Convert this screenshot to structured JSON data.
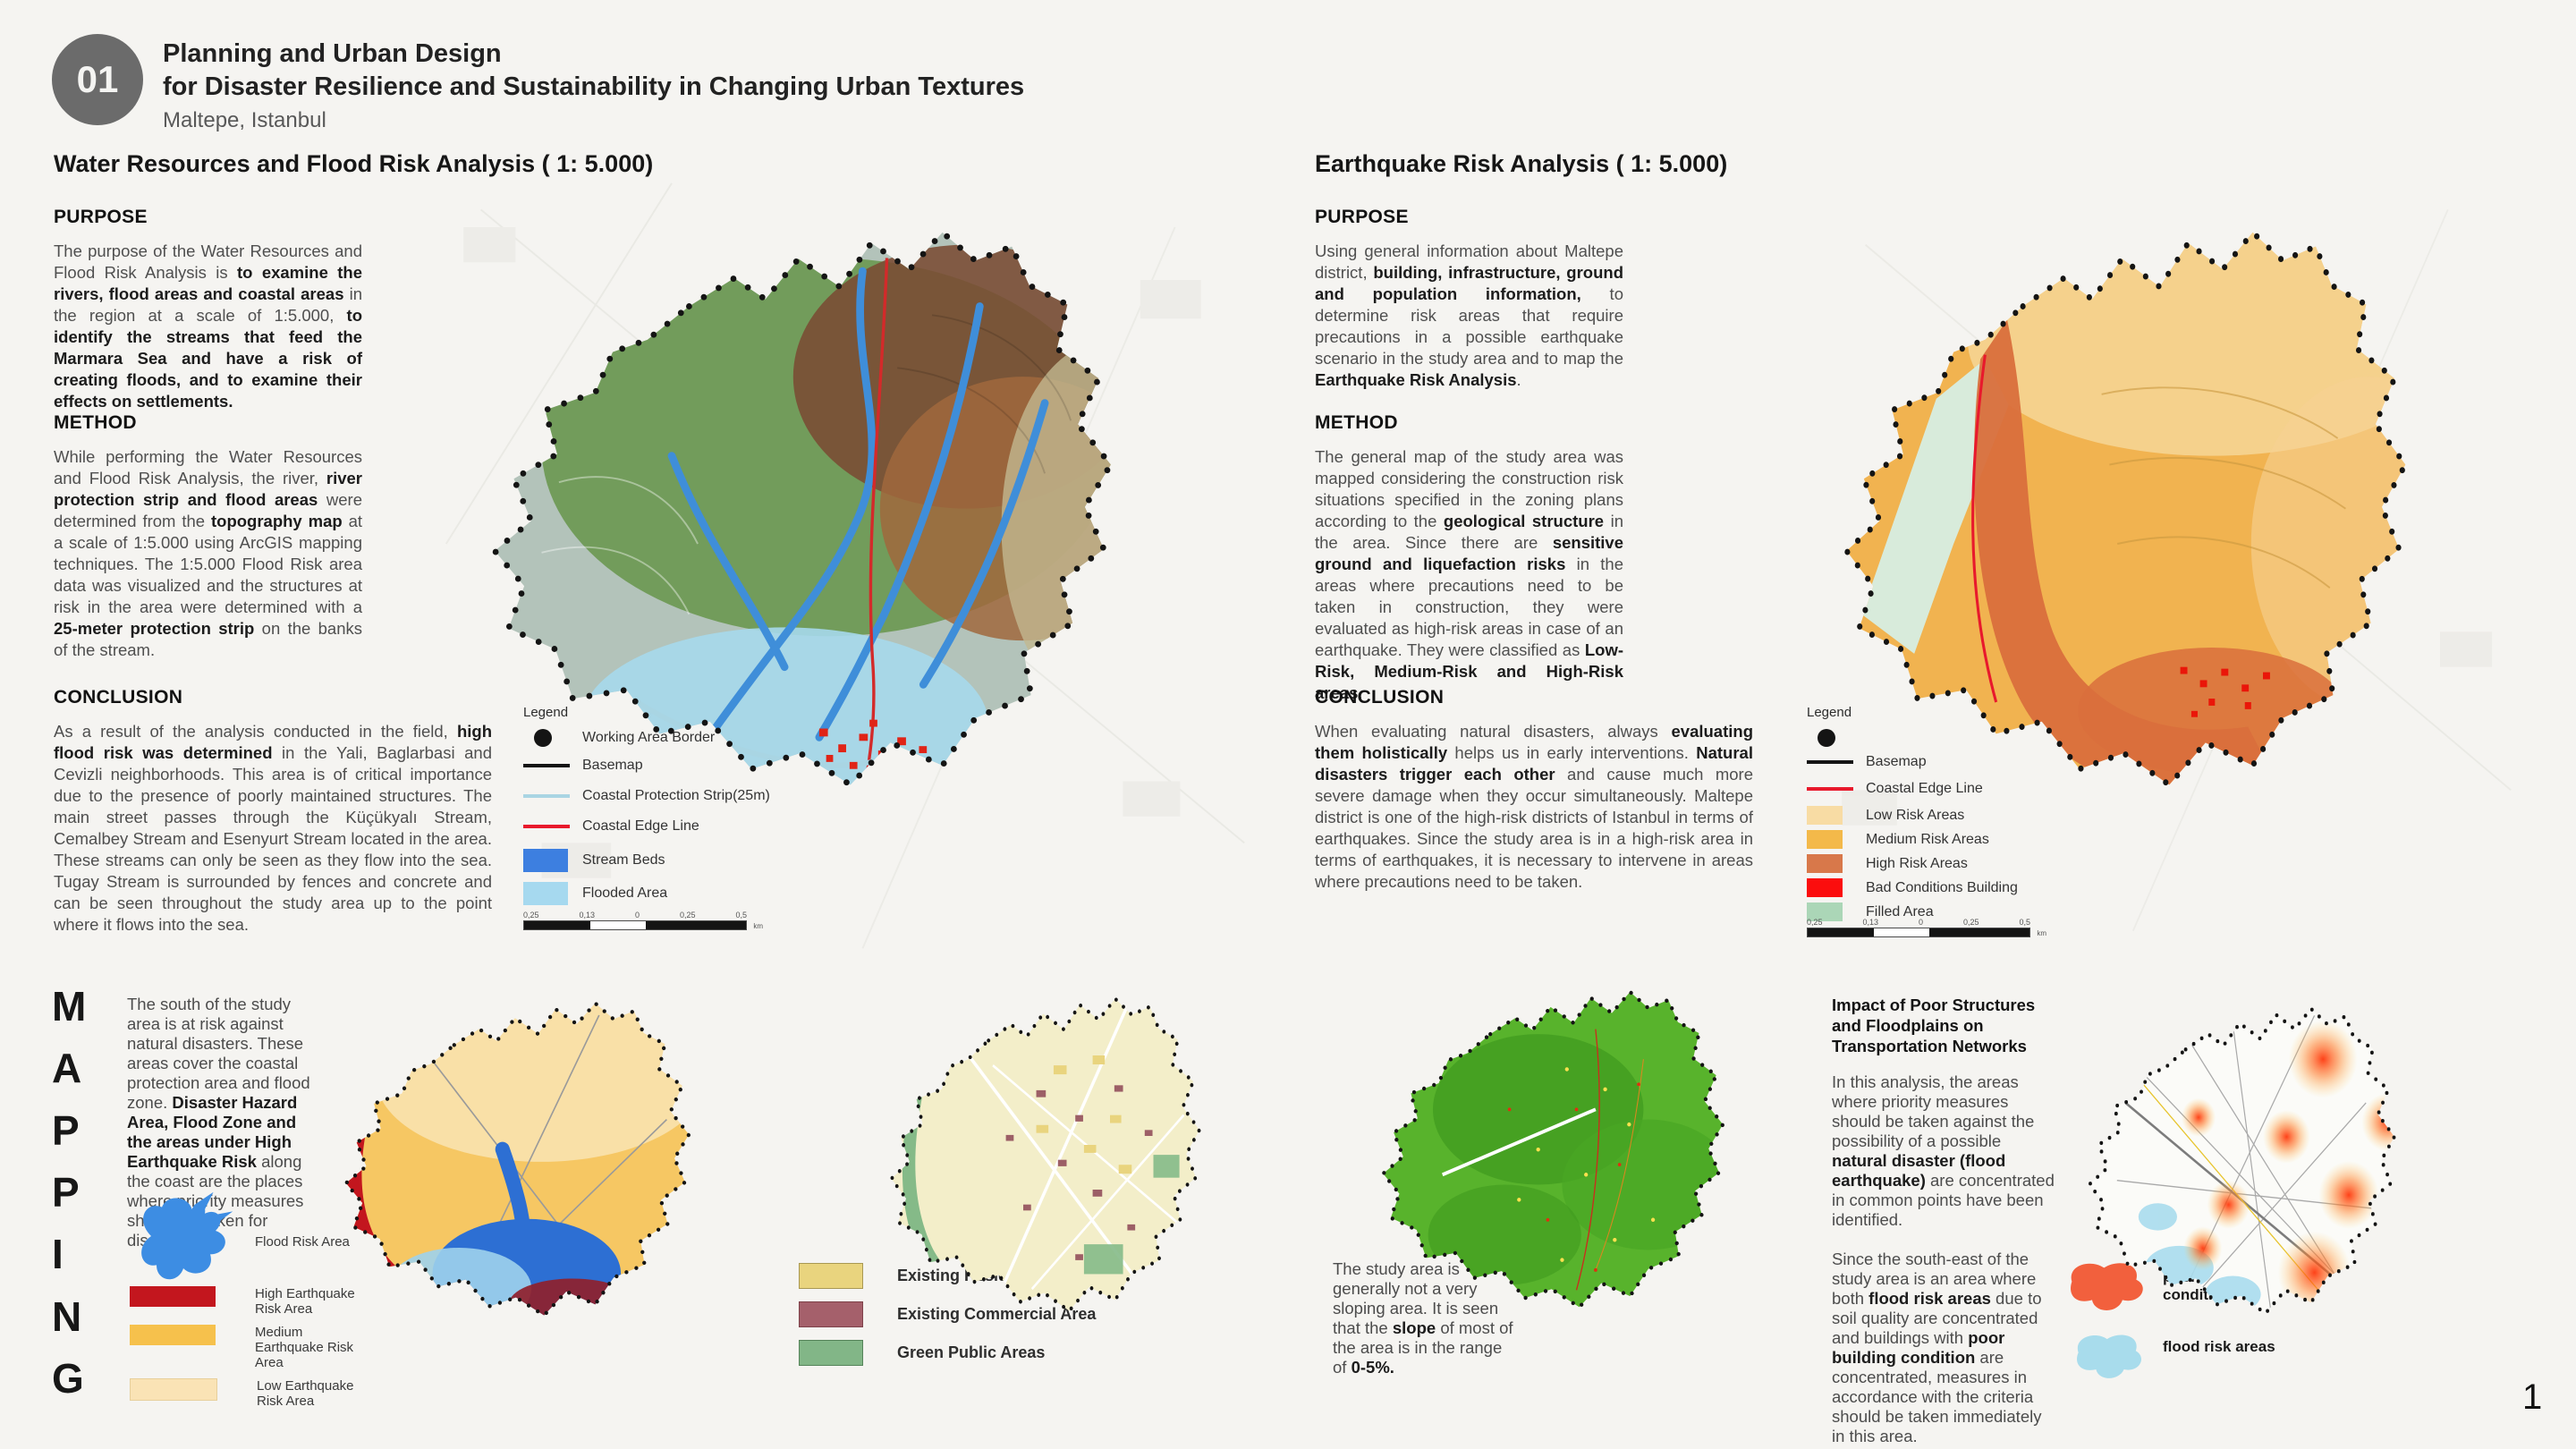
{
  "page": {
    "background": "#f5f4f1",
    "number": "1"
  },
  "header": {
    "badge": "01",
    "badge_color": "#6b6b6b",
    "title_line1": "Planning and Urban Design",
    "title_line2": "for Disaster Resilience and Sustainability in Changing Urban Textures",
    "subtitle": "Maltepe, Istanbul"
  },
  "scalebar": {
    "labels": [
      "0,25",
      "0,13",
      "0",
      "0,25",
      "0,5"
    ],
    "unit": "km"
  },
  "water_panel": {
    "heading": "Water Resources and Flood Risk Analysis ( 1: 5.000)",
    "purpose_title": "PURPOSE",
    "purpose": [
      {
        "t": "The purpose of the Water Resources and Flood Risk Analysis is "
      },
      {
        "t": "to examine the rivers, flood areas and coastal areas",
        "b": true
      },
      {
        "t": " in the region at a scale of 1:5.000, "
      },
      {
        "t": "to identify the streams that feed the Marmara Sea and have a risk of creating floods, and to examine their effects on settlements.",
        "b": true
      }
    ],
    "method_title": "METHOD",
    "method": [
      {
        "t": "While performing the Water Resources and Flood Risk Analysis, the river, "
      },
      {
        "t": "river protection strip and flood areas",
        "b": true
      },
      {
        "t": " were determined from the "
      },
      {
        "t": "topography map",
        "b": true
      },
      {
        "t": " at a scale of 1:5.000 using ArcGIS mapping techniques. The 1:5.000 Flood Risk area data was visualized and the structures at risk in the area were determined with a "
      },
      {
        "t": "25-meter protection strip",
        "b": true
      },
      {
        "t": " on the banks of the stream."
      }
    ],
    "conclusion_title": "CONCLUSION",
    "conclusion": [
      {
        "t": "As a result of the analysis conducted in the field, "
      },
      {
        "t": "high flood risk was determined",
        "b": true
      },
      {
        "t": " in the Yali, Baglarbasi and Cevizli neighborhoods. This area is of critical importance due to the presence of poorly maintained structures. The main street passes through the Küçükyalı Stream, Cemalbey Stream and Esenyurt Stream located in the area. These streams can only be seen as they flow into the sea. Tugay Stream is surrounded by fences and concrete and can be seen throughout the study area up to the point where it flows into the sea."
      }
    ],
    "legend_title": "Legend",
    "legend_items": [
      {
        "type": "dot",
        "color": "#141414",
        "label": "Working Area Border"
      },
      {
        "type": "line",
        "color": "#141414",
        "label": "Basemap"
      },
      {
        "type": "line",
        "color": "#a9d5e3",
        "label": "Coastal Protection Strip(25m)"
      },
      {
        "type": "line",
        "color": "#e8192c",
        "label": "Coastal Edge Line"
      },
      {
        "type": "box",
        "color": "#3d7fe0",
        "label": "Stream Beds"
      },
      {
        "type": "box",
        "color": "#a6d9ef",
        "label": "Flooded Area"
      }
    ]
  },
  "quake_panel": {
    "heading": "Earthquake Risk Analysis ( 1: 5.000)",
    "purpose_title": "PURPOSE",
    "purpose": [
      {
        "t": "Using general information about Maltepe district, "
      },
      {
        "t": "building, infrastructure, ground and population information,",
        "b": true
      },
      {
        "t": " to determine risk areas that require precautions in a possible earthquake scenario in the study area and to map the "
      },
      {
        "t": "Earthquake Risk Analysis",
        "b": true
      },
      {
        "t": "."
      }
    ],
    "method_title": "METHOD",
    "method": [
      {
        "t": "The general map of the study area was mapped considering the construction risk situations specified in the zoning plans according to the "
      },
      {
        "t": "geological structure",
        "b": true
      },
      {
        "t": " in the area. Since there are "
      },
      {
        "t": "sensitive ground and liquefaction risks",
        "b": true
      },
      {
        "t": " in the areas where precautions need to be taken in construction, they were evaluated as high-risk areas in case of an earthquake. They were classified as "
      },
      {
        "t": "Low-Risk, Medium-Risk and High-Risk areas",
        "b": true
      },
      {
        "t": "."
      }
    ],
    "conclusion_title": "CONCLUSION",
    "conclusion": [
      {
        "t": "When evaluating natural disasters, always "
      },
      {
        "t": "evaluating them holistically",
        "b": true
      },
      {
        "t": " helps us in early interventions. "
      },
      {
        "t": "Natural disasters trigger each other",
        "b": true
      },
      {
        "t": " and cause much more severe damage when they occur simultaneously. Maltepe district is one of the high-risk districts of Istanbul in terms of earthquakes. Since the study area is in a high-risk area in terms of earthquakes, it is necessary to intervene in areas where precautions need to be taken."
      }
    ],
    "legend_title": "Legend",
    "legend_items": [
      {
        "type": "dot",
        "color": "#141414",
        "label": ""
      },
      {
        "type": "line",
        "color": "#141414",
        "label": "Basemap"
      },
      {
        "type": "line",
        "color": "#e8192c",
        "label": "Coastal Edge Line"
      },
      {
        "type": "box",
        "color": "#f8dca4",
        "label": "Low Risk Areas"
      },
      {
        "type": "box",
        "color": "#f3b94a",
        "label": "Medium Risk Areas"
      },
      {
        "type": "box",
        "color": "#d8784a",
        "label": "High Risk Areas"
      },
      {
        "type": "box",
        "color": "#fb0d0d",
        "label": "Bad Conditions Building"
      },
      {
        "type": "box",
        "color": "#abd6b7",
        "label": "Filled Area"
      }
    ]
  },
  "mapping": {
    "letters": [
      "M",
      "A",
      "P",
      "P",
      "I",
      "N",
      "G"
    ],
    "intro": [
      {
        "t": "The south of the study area is at risk against natural disasters. These areas cover the coastal protection area and flood zone. "
      },
      {
        "t": "Disaster Hazard Area, Flood Zone and the areas under High Earthquake Risk",
        "b": true
      },
      {
        "t": " along the coast are the places where priority measures should be taken for disasters."
      }
    ],
    "flood_area_label": "Flood Risk Area",
    "eq_legend": [
      {
        "color": "#c3161e",
        "label": "High Earthquake Risk Area"
      },
      {
        "color": "#f6c14c",
        "label": "Medium Earthquake Risk Area"
      },
      {
        "color": "#fae3b5",
        "label": "Low Earthquake Risk Area"
      }
    ],
    "landuse_legend": [
      {
        "color": "#e9d47e",
        "label": "Existing Residential Area"
      },
      {
        "color": "#a5606b",
        "label": "Existing Commercial Area"
      },
      {
        "color": "#82b687",
        "label": "Green Public Areas"
      }
    ],
    "slope_note": [
      {
        "t": "The study area is generally not a very sloping area. It is seen that the "
      },
      {
        "t": "slope",
        "b": true
      },
      {
        "t": " of most of the area is in the range of "
      },
      {
        "t": "0-5%.",
        "b": true
      }
    ],
    "transport": {
      "heading": "Impact of Poor Structures and Floodplains on Transportation Networks",
      "p1": [
        {
          "t": "In this analysis, the areas where priority measures should be taken against the possibility of a possible "
        },
        {
          "t": "natural disaster (flood earthquake)",
          "b": true
        },
        {
          "t": " are concentrated in common points have been identified."
        }
      ],
      "p2": [
        {
          "t": "Since the south-east of the study area is an area where both "
        },
        {
          "t": "flood risk areas",
          "b": true
        },
        {
          "t": " due to soil quality are concentrated and buildings with "
        },
        {
          "t": "poor building condition",
          "b": true
        },
        {
          "t": " are concentrated, measures in accordance with the criteria should be taken immediately in this area."
        }
      ],
      "legend": [
        {
          "color": "#f2603d",
          "label": "poor building condition"
        },
        {
          "color": "#a8dcec",
          "label": "flood risk areas"
        }
      ]
    }
  }
}
